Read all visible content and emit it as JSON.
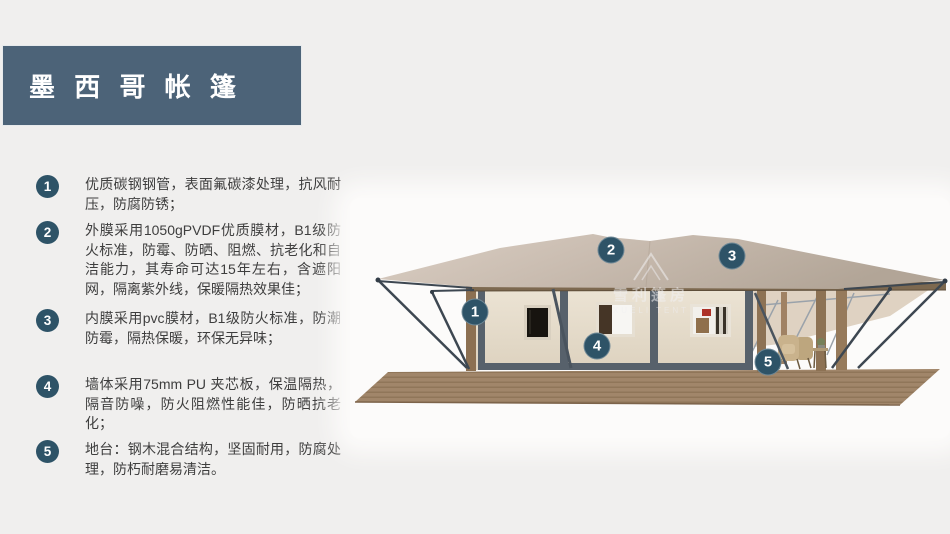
{
  "title": {
    "text": "墨 西 哥 帐 篷"
  },
  "features": [
    {
      "num": "1",
      "text": "优质碳钢钢管，表面氟碳漆处理，抗风耐压，防腐防锈；"
    },
    {
      "num": "2",
      "text": "外膜采用1050gPVDF优质膜材，B1级防火标准，防霉、防晒、阻燃、抗老化和自洁能力，其寿命可达15年左右，含遮阳网，隔离紫外线，保暖隔热效果佳；"
    },
    {
      "num": "3",
      "text": "内膜采用pvc膜材，B1级防火标准，防潮防霉，隔热保暖，环保无异味；"
    },
    {
      "num": "4",
      "text": "墙体采用75mm PU 夹芯板，保温隔热，隔音防噪，防火阻燃性能佳，防晒抗老化；"
    },
    {
      "num": "5",
      "text": "地台：钢木混合结构，坚固耐用，防腐处理，防朽耐磨易清洁。"
    }
  ],
  "callouts": [
    {
      "num": "1"
    },
    {
      "num": "2"
    },
    {
      "num": "3"
    },
    {
      "num": "4"
    },
    {
      "num": "5"
    }
  ],
  "watermark": {
    "cn": "雪利篷房",
    "en": "XUELI TENT"
  },
  "colors": {
    "background": "#f0efee",
    "title_bg": "#4c6378",
    "badge": "#2e5367",
    "text": "#3e3e3e",
    "roof": "#c9bcb0",
    "wall": "#eae1d1",
    "frame": "#57616b",
    "wood": "#8d7254",
    "deck": "#a1866a"
  }
}
